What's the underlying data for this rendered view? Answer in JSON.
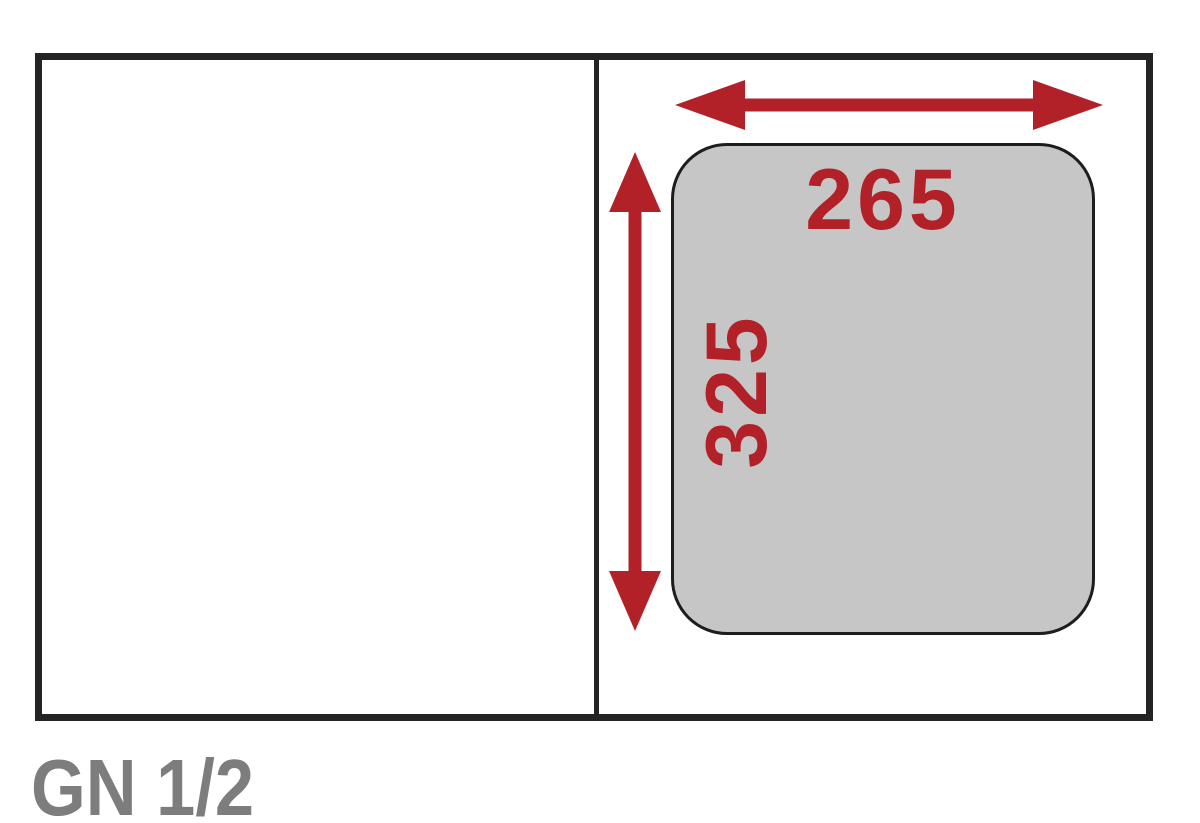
{
  "diagram": {
    "pan_size_label": "GN 1/2",
    "width_mm": "265",
    "height_mm": "325"
  },
  "colors": {
    "accent-red": "#b22028",
    "pan-fill": "#c6c6c6",
    "outline-dark": "#242424",
    "outline-darkest": "#1d1d1b",
    "label-gray": "#7d7d7d"
  }
}
